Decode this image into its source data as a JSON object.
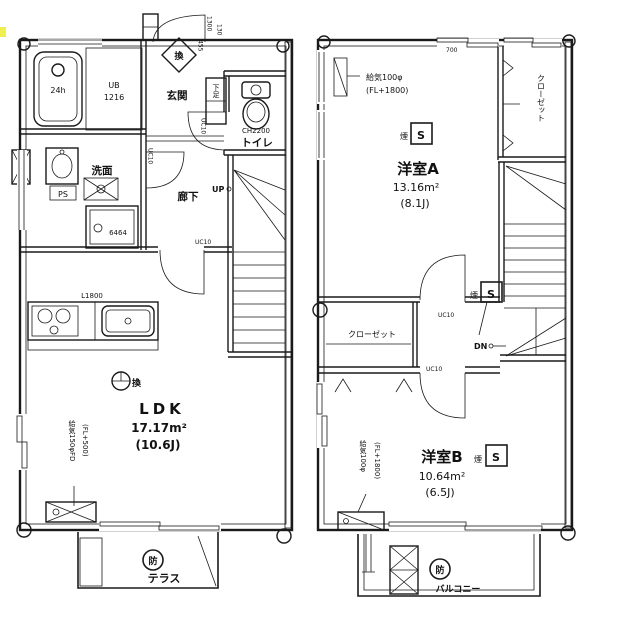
{
  "floor1": {
    "bath": {
      "tub": "24h",
      "ub": "UB",
      "ub_size": "1216"
    },
    "entrance": {
      "label": "玄関",
      "shoebox": "下足",
      "vent": "換"
    },
    "toilet": {
      "label": "トイレ",
      "ch": "CH2200",
      "uc": "UC10"
    },
    "washroom": {
      "label": "洗面",
      "ps": "PS",
      "pan": "6464"
    },
    "hallway": {
      "label": "廊下",
      "uc": "UC10"
    },
    "stairs": {
      "up": "UP",
      "uc": "UC10"
    },
    "ldk": {
      "label": "LDK",
      "area": "17.17m²",
      "tatami": "(10.6J)",
      "vent": "換",
      "kitchen": "L1800"
    },
    "terrace": {
      "label": "テラス",
      "fire": "防"
    },
    "supply": {
      "line1": "給気150φFD",
      "line2": "(FL+500)"
    },
    "dims": {
      "d1": "1300",
      "d2": "130",
      "d3": "455"
    }
  },
  "floor2": {
    "room_a": {
      "label": "洋室A",
      "area": "13.16m²",
      "tatami": "(8.1J)",
      "smoke": "煙",
      "smoke_s": "S"
    },
    "room_b": {
      "label": "洋室B",
      "area": "10.64m²",
      "tatami": "(6.5J)",
      "smoke": "煙",
      "smoke_s": "S"
    },
    "closet_a": {
      "label": "クローゼット"
    },
    "closet_b": {
      "label": "クローゼット"
    },
    "stairs": {
      "dn": "DN",
      "smoke": "煙",
      "smoke_s": "S",
      "uc1": "UC10",
      "uc2": "UC10"
    },
    "supply_a": {
      "line1": "給気100φ",
      "line2": "(FL+1800)"
    },
    "supply_b": {
      "line1": "給気100φ",
      "line2": "(FL+1800)"
    },
    "balcony": {
      "label": "バルコニー",
      "fire": "防"
    },
    "dims": {
      "d1": "700"
    }
  }
}
